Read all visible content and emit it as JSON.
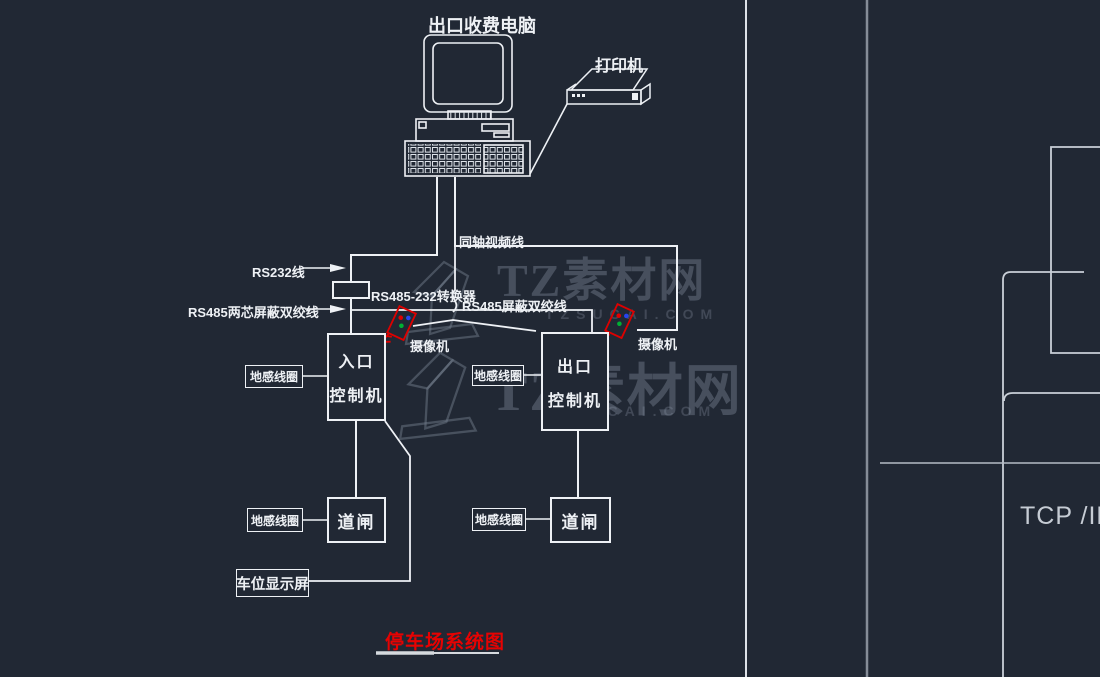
{
  "computer_label": "出口收费电脑",
  "printer_label": "打印机",
  "wiring": {
    "rs232": "RS232线",
    "rs485_two_core": "RS485两芯屏蔽双绞线",
    "converter": "RS485-232转换器",
    "coax": "同轴视频线",
    "rs485_shielded": "RS485屏蔽双绞线"
  },
  "entrance": {
    "controller_line1": "入口",
    "controller_line2": "控制机",
    "camera": "摄像机",
    "loop_mid": "地感线圈",
    "loop_bottom": "地感线圈",
    "gate": "道闸",
    "display": "车位显示屏"
  },
  "exit": {
    "controller_line1": "出口",
    "controller_line2": "控制机",
    "camera": "摄像机",
    "loop_mid": "地感线圈",
    "loop_bottom": "地感线圈",
    "gate": "道闸"
  },
  "title": "停车场系统图",
  "network_label": "TCP /IP",
  "watermark": {
    "brand": "TZ素材网",
    "domain": "TZSUCAI.COM"
  },
  "colors": {
    "background": "#212834",
    "line_white": "#eef1f5",
    "accent_red": "#e60202",
    "camera_red": "#dd0000",
    "cad_gray": "#8a919c",
    "watermark_gray": "#8b95a4"
  }
}
